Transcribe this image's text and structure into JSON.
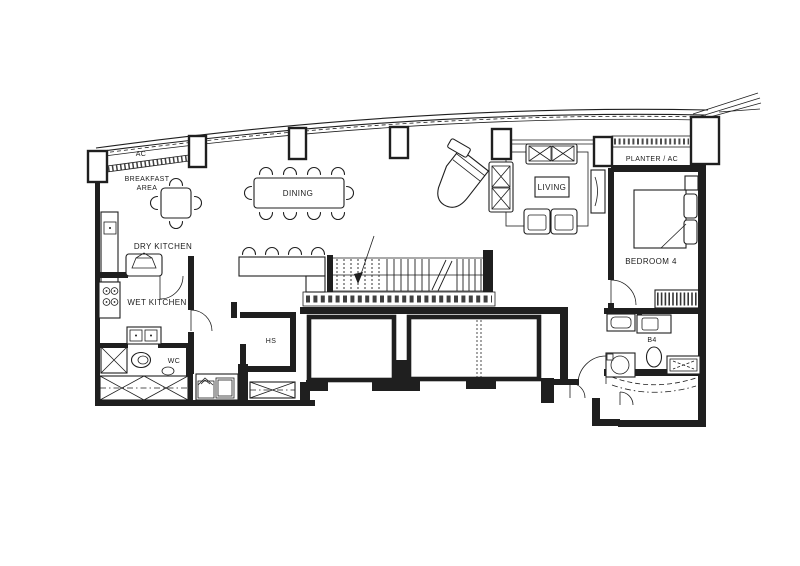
{
  "drawing": {
    "kind": "apartment floor plan (scanned line drawing)",
    "colors": {
      "ink": "#1f1f1f",
      "paper": "#ffffff"
    }
  },
  "labels": {
    "ac": "AC",
    "breakfast_1": "BREAKFAST",
    "breakfast_2": "AREA",
    "dry_kitchen": "DRY KITCHEN",
    "wet_kitchen": "WET KITCHEN",
    "wc": "WC",
    "dining": "DINING",
    "living": "LIVING",
    "planter_ac": "PLANTER / AC",
    "bedroom4": "BEDROOM 4",
    "b4": "B4",
    "hs": "HS"
  }
}
